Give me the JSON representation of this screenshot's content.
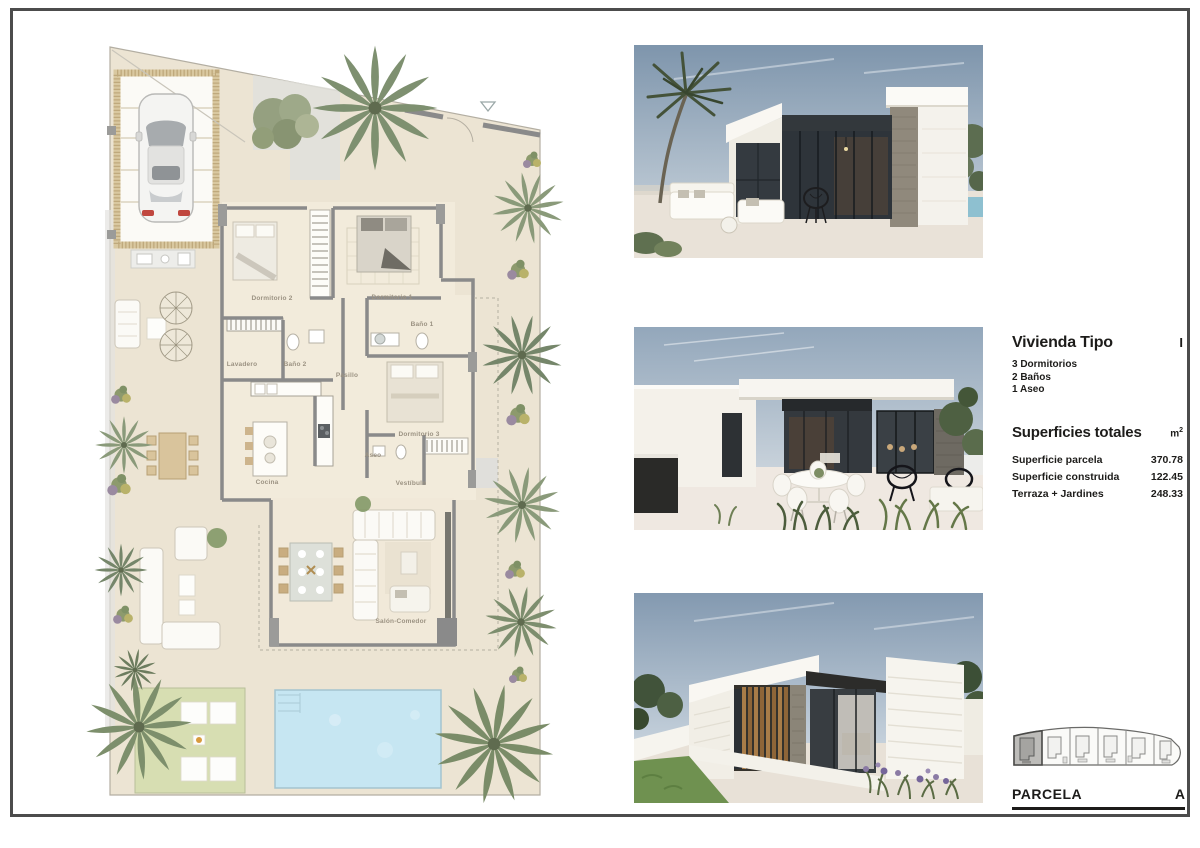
{
  "info": {
    "title": "Vivienda Tipo",
    "index": "I",
    "features": [
      "3 Dormitorios",
      "2 Baños",
      "1 Aseo"
    ],
    "surfaces": {
      "heading": "Superficies totales",
      "unit": "m",
      "unit_exp": "2",
      "rows": [
        {
          "label": "Superficie parcela",
          "value": "370.78"
        },
        {
          "label": "Superficie construida",
          "value": "122.45"
        },
        {
          "label": "Terraza + Jardines",
          "value": "248.33"
        }
      ]
    }
  },
  "parcel_footer": {
    "label": "PARCELA",
    "value": "A",
    "parcel_count": 6,
    "highlighted_parcel": 1
  },
  "plan": {
    "rooms": {
      "dormitorio2": "Dormitorio 2",
      "dormitorio1": "Dormitorio 1",
      "bano1": "Baño 1",
      "bano2": "Baño 2",
      "lavadero": "Lavadero",
      "pasillo": "Pasillo",
      "cocina": "Cocina",
      "aseo": "Aseo",
      "dormitorio3": "Dormitorio 3",
      "vestibulo": "Vestíbulo",
      "salon": "Salón-Comedor"
    }
  },
  "photos": [
    {
      "label": "render-terraza-porche"
    },
    {
      "label": "render-terraza-comedor-exterior"
    },
    {
      "label": "render-fachada-lateral-jardin"
    }
  ],
  "colors": {
    "frame": "#4c4c4c",
    "terrain": "#ece4d3",
    "interior_floor": "#f2ebdb",
    "wall": "#8a8a8a",
    "pergola": "#d9c8a0",
    "pool": "#c6e6f2",
    "lawn": "#d7deb2",
    "palm": "#7e9070",
    "text": "#1d1c1a"
  }
}
